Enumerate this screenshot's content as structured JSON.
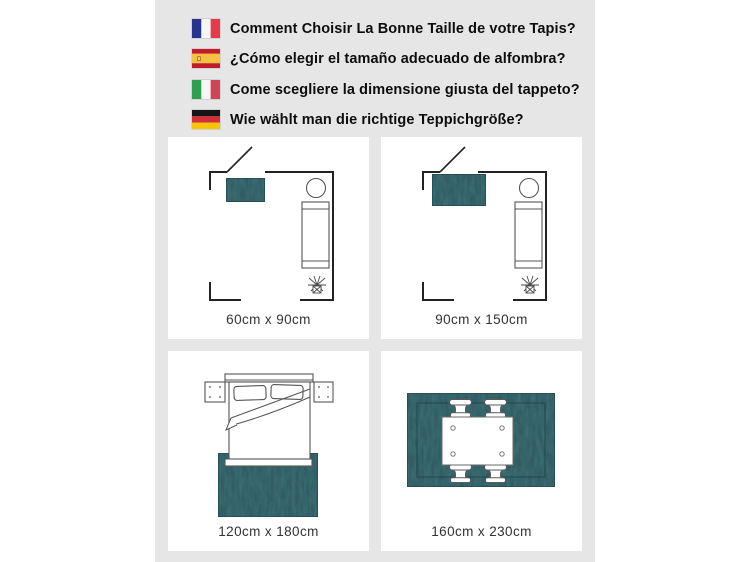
{
  "header": {
    "items": [
      {
        "lang": "fr",
        "flag": "france-flag",
        "text": "Comment Choisir La Bonne Taille de votre Tapis?"
      },
      {
        "lang": "es",
        "flag": "spain-flag",
        "text": "¿Cómo elegir el tamaño adecuado de alfombra?"
      },
      {
        "lang": "it",
        "flag": "italy-flag",
        "text": "Come scegliere la dimensione giusta del tappeto?"
      },
      {
        "lang": "de",
        "flag": "germany-flag",
        "text": "Wie wählt man die richtige Teppichgröße?"
      }
    ]
  },
  "panels": [
    {
      "scene": "living-room-floor-plan-small-rug",
      "label": "60cm x 90cm"
    },
    {
      "scene": "living-room-floor-plan-medium-rug",
      "label": "90cm x 150cm"
    },
    {
      "scene": "bedroom-bed-on-rug",
      "label": "120cm x 180cm"
    },
    {
      "scene": "dining-table-on-rug",
      "label": "160cm x 230cm"
    }
  ],
  "colors": {
    "canvas_background": "#ffffff",
    "strip_background": "#e6e6e6",
    "panel_background": "#ffffff",
    "rug_teal": "#47787e",
    "rug_noise_dark": "#0a272d",
    "rug_edge": "#1d454c",
    "wall_line": "#222222",
    "furniture_line": "#555555",
    "header_text": "#0d0d0d",
    "label_text": "#333333",
    "flag_france": {
      "blue": "#27348f",
      "white": "#f6f6f6",
      "red": "#e8394a"
    },
    "flag_spain": {
      "red": "#c01b26",
      "yellow": "#f6c13f",
      "emblem": "#a8642f"
    },
    "flag_italy": {
      "green": "#2f9e4f",
      "white": "#f6f6f6",
      "red": "#cf4553"
    },
    "flag_germany": {
      "black": "#151515",
      "red": "#d32f38",
      "gold": "#f7c506"
    }
  }
}
